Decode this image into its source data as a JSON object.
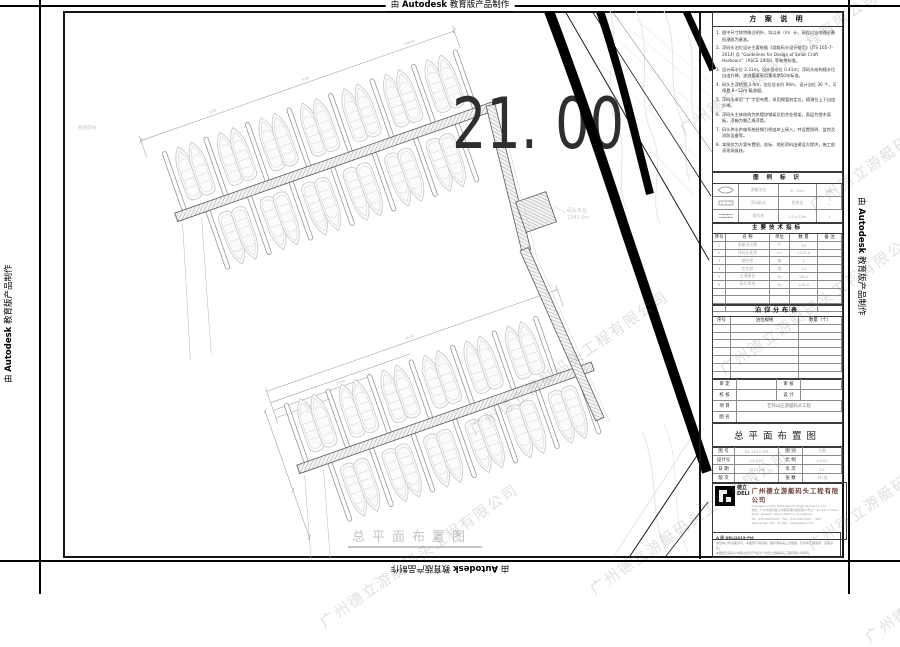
{
  "watermark": {
    "autodesk": {
      "prefix": "由",
      "brand": "Autodesk",
      "suffix": "教育版产品制作"
    },
    "company_diagonal": "广州德立游艇码头工程有限公司"
  },
  "drawing": {
    "elevation_label": "21. 00",
    "platform_label_line1": "码头平台",
    "platform_label_line2": "1341.0m",
    "shore_label": "规划岸线",
    "bottom_title": "总平面布置图",
    "dims": [
      "4.00",
      "4.00",
      "138.00",
      "3.00",
      "12.50",
      "44.00"
    ]
  },
  "titleblock": {
    "notes": {
      "title": "方 案 说 明",
      "items": [
        "图中尺寸除特殊注明外，均以米（m）计，高程以当地理论最低潮面为基准。",
        "浮码头泊位设计主要依据《游艇码头设计规范》(JTS 165-7-2014) 及 “Guidelines for Design of Small Craft Harbours”（ASCE 2000）等有关标准。",
        "设计高水位 2.31m，设计低水位 0.41m；浮码头结构随水位自由升降，波浪要素采用重现期50年标准。",
        "码头主浮桥宽 3.0m，泊位总长约 96m，设计泊位 30 个，可停靠 8~12m 级游艇。",
        "浮码头采用“丁”字型布置，采用钢管桩定位，随潮位上下自由升降。",
        "浮码头主体结构为热镀锌钢架及铝合金框架，面层为塑木面板，浮箱为聚乙烯浮筒。",
        "码头供水供电系统经钢引桥由岸上接入，并设置照明、监控及消防设备等。",
        "本图仅为方案布置图，坐标、地形资料由建设方提供，施工前须现场复核。"
      ]
    },
    "legend": {
      "title": "图 例 标 识",
      "rows": [
        {
          "name": "游艇泊位",
          "spec": "8~12m",
          "qty": "30"
        },
        {
          "name": "浮动码头",
          "spec": "铝合金",
          "qty": "—"
        },
        {
          "name": "钢引桥",
          "spec": "2.0×12m",
          "qty": "1"
        }
      ]
    },
    "tech": {
      "title": "主要技术指标",
      "headers": [
        "序号",
        "名  称",
        "单位",
        "数 量",
        "备 注"
      ],
      "rows": [
        [
          "1",
          "游艇泊位数",
          "个",
          "30",
          ""
        ],
        [
          "2",
          "浮码头面积",
          "m²",
          "1341.0",
          ""
        ],
        [
          "3",
          "钢引桥",
          "座",
          "1",
          ""
        ],
        [
          "4",
          "定位桩",
          "根",
          "14",
          ""
        ],
        [
          "5",
          "主通道长",
          "m",
          "96.0",
          ""
        ],
        [
          "6",
          "码头岸线",
          "m",
          "120.0",
          ""
        ]
      ]
    },
    "berth": {
      "title": "泊位分布表",
      "headers": [
        "序号",
        "泊位规格",
        "数量（个）"
      ]
    },
    "sign": {
      "r1l": "审 定",
      "r1r": "审 核",
      "r2l": "校 核",
      "r2r": "设 计",
      "project_label": "项 目",
      "project": "艺邦山庄游艇码头工程",
      "name_label": "图 名"
    },
    "sheet_title": "总平面布置图",
    "info": {
      "rows": [
        [
          "图 号",
          "DL-2015-PM",
          "图 别",
          "方案"
        ],
        [
          "设计号",
          "15-023",
          "比 例",
          "1:500"
        ],
        [
          "日 期",
          "2015.06",
          "页 次",
          "1/1"
        ],
        [
          "版 次",
          "A",
          "张 数",
          "共1张"
        ]
      ]
    },
    "company": {
      "logo_cn": "德立",
      "logo_en": "DELI",
      "name_cn": "广州德立游艇码头工程有限公司",
      "name_en": "Guangzhou Deli Yacht Marina Engineering Co.,Ltd",
      "addr1": "地址：广州市番禺区沙湾镇福涌村福贤路61号之一  No.61-1 Fuxian Road, Shawan, Panyu District, Guangzhou",
      "addr2": "Tel：020-34872223　Fax：020-34872223　Http：www.gzdeli.com　E-mail：deli@gzdeli.com"
    },
    "footnote1": "A 级 DELI2015-PM",
    "footnote2": "未经本公司书面许可，本图纸不得复制、翻印或向第三方披露，仅供本工程使用，违者必究。",
    "footnote3": "本图纸及其设计内容之知识产权归广州德立游艇码头工程有限公司所有。"
  }
}
